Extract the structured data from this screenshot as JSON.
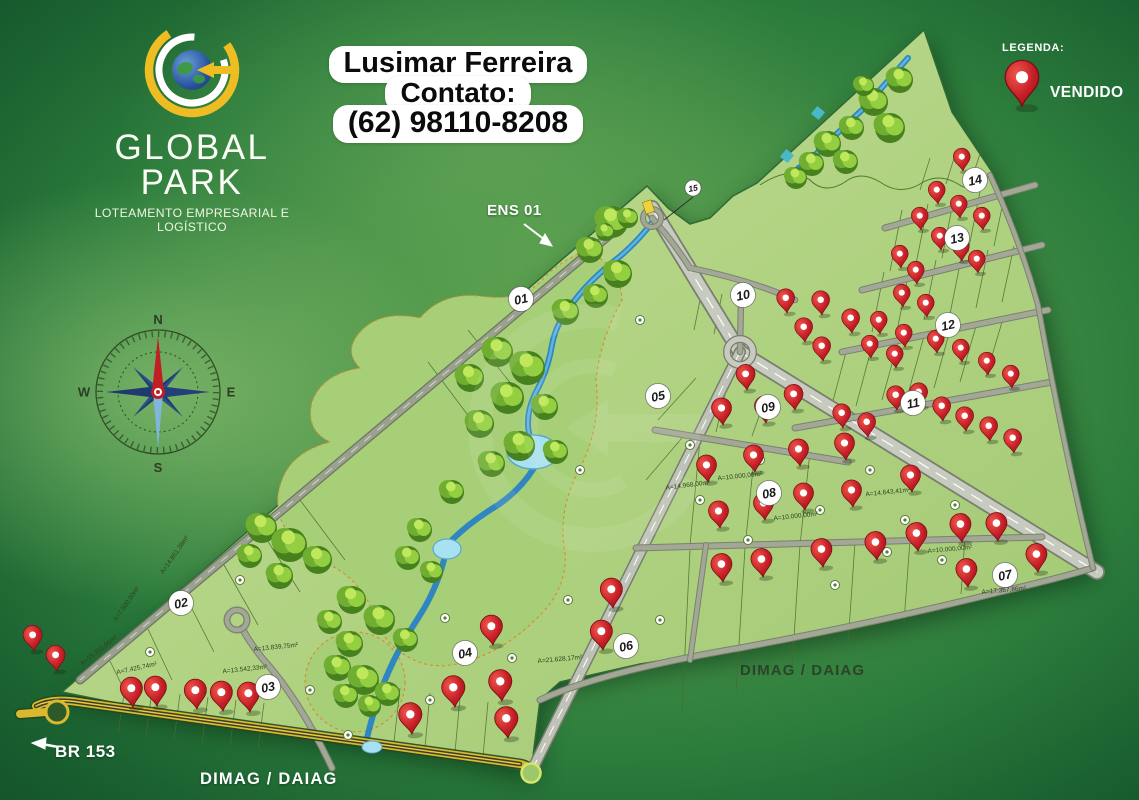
{
  "branding": {
    "title": "GLOBAL PARK",
    "subtitle": "LOTEAMENTO EMPRESARIAL E LOGÍSTICO"
  },
  "contact": {
    "name": "Lusimar Ferreira",
    "label": "Contato:",
    "phone": "(62) 98110-8208"
  },
  "legend": {
    "title": "LEGENDA:",
    "sold_label": "VENDIDO"
  },
  "compass": {
    "n": "N",
    "e": "E",
    "s": "S",
    "w": "W"
  },
  "road_labels": {
    "ens": "ENS 01",
    "br": "BR 153",
    "dimag_bottom": "DIMAG / DAIAG",
    "dimag_right": "DIMAG / DAIAG"
  },
  "entrance_marker": {
    "label": "15",
    "x": 693,
    "y": 188
  },
  "blocks": [
    {
      "number": "01",
      "x": 521,
      "y": 299
    },
    {
      "number": "02",
      "x": 181,
      "y": 603
    },
    {
      "number": "03",
      "x": 268,
      "y": 687
    },
    {
      "number": "04",
      "x": 465,
      "y": 653
    },
    {
      "number": "05",
      "x": 658,
      "y": 396
    },
    {
      "number": "06",
      "x": 626,
      "y": 646
    },
    {
      "number": "07",
      "x": 1005,
      "y": 575
    },
    {
      "number": "08",
      "x": 769,
      "y": 493
    },
    {
      "number": "09",
      "x": 768,
      "y": 407
    },
    {
      "number": "10",
      "x": 743,
      "y": 295
    },
    {
      "number": "11",
      "x": 913,
      "y": 403
    },
    {
      "number": "12",
      "x": 948,
      "y": 325
    },
    {
      "number": "13",
      "x": 957,
      "y": 238
    },
    {
      "number": "14",
      "x": 975,
      "y": 180
    }
  ],
  "sold_pins": [
    [
      963,
      171,
      0.8
    ],
    [
      938,
      204,
      0.8
    ],
    [
      960,
      218,
      0.8
    ],
    [
      921,
      230,
      0.8
    ],
    [
      983,
      230,
      0.8
    ],
    [
      941,
      250,
      0.8
    ],
    [
      962,
      261,
      0.8
    ],
    [
      901,
      268,
      0.8
    ],
    [
      978,
      273,
      0.8
    ],
    [
      917,
      284,
      0.8
    ],
    [
      903,
      307,
      0.8
    ],
    [
      927,
      317,
      0.8
    ],
    [
      880,
      334,
      0.8
    ],
    [
      905,
      347,
      0.8
    ],
    [
      937,
      353,
      0.8
    ],
    [
      871,
      358,
      0.8
    ],
    [
      896,
      368,
      0.8
    ],
    [
      962,
      362,
      0.8
    ],
    [
      988,
      375,
      0.8
    ],
    [
      1012,
      388,
      0.8
    ],
    [
      843,
      428,
      0.85
    ],
    [
      868,
      437,
      0.85
    ],
    [
      897,
      410,
      0.85
    ],
    [
      920,
      407,
      0.85
    ],
    [
      943,
      421,
      0.85
    ],
    [
      966,
      431,
      0.85
    ],
    [
      990,
      441,
      0.85
    ],
    [
      1014,
      453,
      0.85
    ],
    [
      787,
      313,
      0.85
    ],
    [
      822,
      315,
      0.85
    ],
    [
      805,
      342,
      0.85
    ],
    [
      852,
      333,
      0.85
    ],
    [
      823,
      361,
      0.85
    ],
    [
      747,
      390,
      0.9
    ],
    [
      795,
      410,
      0.9
    ],
    [
      723,
      425,
      0.95
    ],
    [
      766,
      423,
      0.95
    ],
    [
      846,
      460,
      0.95
    ],
    [
      800,
      466,
      0.95
    ],
    [
      755,
      472,
      0.95
    ],
    [
      708,
      482,
      0.95
    ],
    [
      912,
      492,
      0.95
    ],
    [
      805,
      510,
      0.95
    ],
    [
      853,
      507,
      0.95
    ],
    [
      765,
      520,
      0.95
    ],
    [
      720,
      528,
      0.95
    ],
    [
      723,
      582,
      1
    ],
    [
      763,
      577,
      1
    ],
    [
      823,
      567,
      1
    ],
    [
      877,
      560,
      1
    ],
    [
      918,
      551,
      1
    ],
    [
      962,
      542,
      1
    ],
    [
      998,
      541,
      1
    ],
    [
      968,
      587,
      1
    ],
    [
      1038,
      572,
      1
    ],
    [
      613,
      608,
      1.05
    ],
    [
      603,
      650,
      1.05
    ],
    [
      493,
      645,
      1.05
    ],
    [
      508,
      738,
      1.1
    ],
    [
      502,
      701,
      1.1
    ],
    [
      455,
      707,
      1.1
    ],
    [
      412,
      734,
      1.1
    ],
    [
      250,
      712,
      1.05
    ],
    [
      223,
      711,
      1.05
    ],
    [
      197,
      709,
      1.05
    ],
    [
      157,
      706,
      1.05
    ],
    [
      133,
      707,
      1.05
    ],
    [
      34,
      651,
      0.9
    ],
    [
      57,
      671,
      0.9
    ]
  ],
  "lot_area_labels": [
    {
      "text": "A=15.310,06m²",
      "x": 100,
      "y": 652,
      "rot": -38
    },
    {
      "text": "A=14.861,38m²",
      "x": 176,
      "y": 556,
      "rot": -55
    },
    {
      "text": "A=7.500,00m²",
      "x": 128,
      "y": 605,
      "rot": -55
    },
    {
      "text": "A=7.425,74m²",
      "x": 137,
      "y": 670,
      "rot": -12
    },
    {
      "text": "A=13.542,33m²",
      "x": 245,
      "y": 671,
      "rot": -6
    },
    {
      "text": "A=13.839,75m²",
      "x": 276,
      "y": 649,
      "rot": -6
    },
    {
      "text": "A=21.628,17m²",
      "x": 560,
      "y": 661,
      "rot": -5
    },
    {
      "text": "A=14.968,00m²",
      "x": 688,
      "y": 487,
      "rot": -7
    },
    {
      "text": "A=14.643,41m²",
      "x": 888,
      "y": 494,
      "rot": -6
    },
    {
      "text": "A=10.000,00m²",
      "x": 740,
      "y": 478,
      "rot": -6
    },
    {
      "text": "A=10.000,00m²",
      "x": 796,
      "y": 518,
      "rot": -6
    },
    {
      "text": "A=10.000,00m²",
      "x": 950,
      "y": 551,
      "rot": -5
    },
    {
      "text": "A=17.367,86m²",
      "x": 1004,
      "y": 592,
      "rot": -5
    }
  ],
  "colors": {
    "pin_red": "#c8232c",
    "map_surface": "#b2d484",
    "background": "#114e27",
    "road_gray": "#a2a796",
    "avenue_light": "#c6cabf",
    "highway_yellow": "#d9b92f",
    "water": "#3e8fc4",
    "lake": "#a8e2f2",
    "accent_yellow": "#eebd23"
  }
}
